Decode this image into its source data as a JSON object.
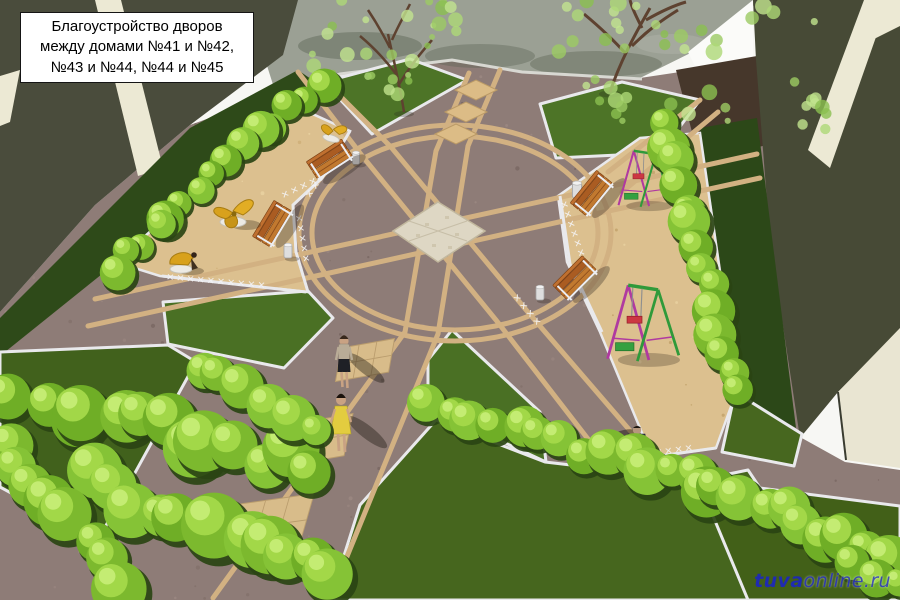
{
  "annotation": {
    "title_lines": [
      "Благоустройство дворов",
      "между домами №41 и №42,",
      "№43 и №44, №44 и №45"
    ]
  },
  "watermark": {
    "bold_part": "tuva",
    "light_part": "online.ru"
  },
  "scene": {
    "type": "3d-architectural-render",
    "description": "Aerial 3D visualization of a courtyard improvement plan: circular paved plaza with radiating paths and a cobbled centre square, lawns with white curbs, bright trimmed hedges, two sand playgrounds with benches, litter bins, swing sets and yellow play sculptures, three pedestrians, dark building facades framing the yard and a road along the top.",
    "objects": [
      {
        "name": "circular-plaza",
        "note": "round paved plaza with cobbled center square and radiating paths"
      },
      {
        "name": "left-playground",
        "note": "sand area with yellow play sculptures, two benches, litter bins, white lattice fence"
      },
      {
        "name": "right-playground",
        "note": "sand area with two swing sets, two benches, litter bins, white lattice fence"
      },
      {
        "name": "lawns",
        "note": "green lawns edged with white curbs"
      },
      {
        "name": "hedges",
        "note": "bright green trimmed shrub rows"
      },
      {
        "name": "trees",
        "note": "two young trees by the road"
      },
      {
        "name": "pedestrians",
        "note": "woman in grey top, woman in yellow dress, man in dark suit"
      },
      {
        "name": "buildings",
        "note": "dark facades of apartment houses at the corners"
      }
    ],
    "palette": {
      "paving": "#8e7c77",
      "path_bands": "#d2b182",
      "sand": "#dcc08f",
      "lawn": "#4c7326",
      "hedge": "#86c436",
      "building": "#4a4c3c",
      "building_stripe": "#ece9d4",
      "road": "#9ba094",
      "bench_wood": "#b4672a",
      "swing_magenta": "#b03aa0",
      "swing_green": "#2f9a3a",
      "equipment_yellow": "#d8a11c",
      "center_square": "#ded7c4",
      "curb_white": "#e9e9ec",
      "watermark_blue": "#2d35c9"
    }
  }
}
